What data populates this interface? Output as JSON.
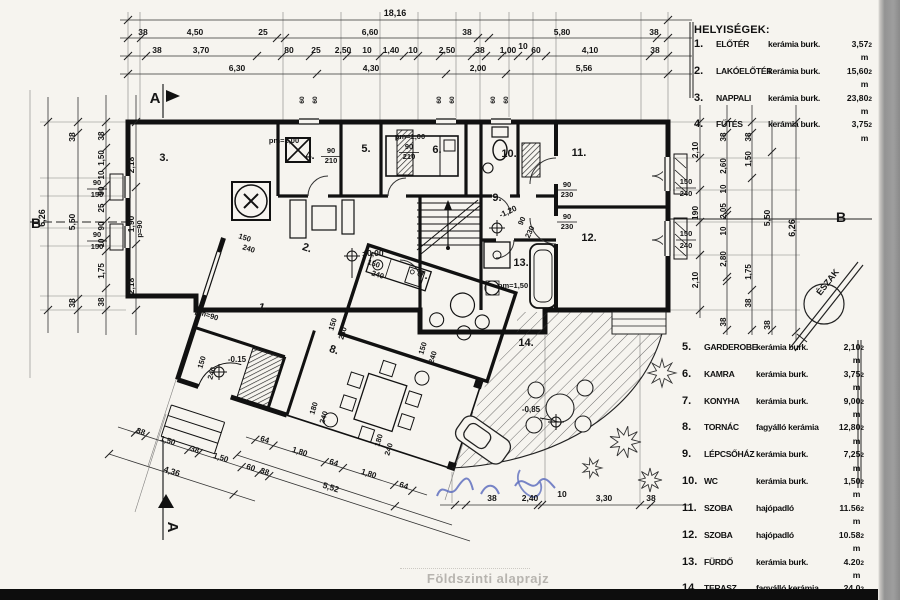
{
  "title": {
    "caption": "Földszinti alaprajz"
  },
  "legend_top": {
    "heading": "HELYISÉGEK:",
    "items": [
      {
        "num": "1.",
        "name": "ELŐTÉR",
        "material": "kerámia burk.",
        "area": "3,57 m"
      },
      {
        "num": "2.",
        "name": "LAKÓELŐTÉR",
        "material": "kerámia burk.",
        "area": "15,60 m"
      },
      {
        "num": "3.",
        "name": "NAPPALI",
        "material": "kerámia burk.",
        "area": "23,80 m"
      },
      {
        "num": "4.",
        "name": "FŰTÉS",
        "material": "kerámia burk.",
        "area": "3,75 m"
      }
    ]
  },
  "legend_bottom": {
    "items": [
      {
        "num": "5.",
        "name": "GARDEROBE",
        "material": "kerámia burk.",
        "area": "2,10 m"
      },
      {
        "num": "6.",
        "name": "KAMRA",
        "material": "kerámia burk.",
        "area": "3,75 m"
      },
      {
        "num": "7.",
        "name": "KONYHA",
        "material": "kerámia burk.",
        "area": "9,00 m"
      },
      {
        "num": "8.",
        "name": "TORNÁC",
        "material": "fagyálló kerámia",
        "area": "12,80 m"
      },
      {
        "num": "9.",
        "name": "LÉPCSŐHÁZ",
        "material": "kerámia burk.",
        "area": "7,25 m"
      },
      {
        "num": "10.",
        "name": "WC",
        "material": "kerámia burk.",
        "area": "1,50 m"
      },
      {
        "num": "11.",
        "name": "SZOBA",
        "material": "hajópadló",
        "area": "11.56 m"
      },
      {
        "num": "12.",
        "name": "SZOBA",
        "material": "hajópadló",
        "area": "10.58 m"
      },
      {
        "num": "13.",
        "name": "FÜRDŐ",
        "material": "kerámia burk.",
        "area": "4.20 m"
      },
      {
        "num": "14.",
        "name": "TERASZ",
        "material": "fagyálló kerámia",
        "area": "24,0 m"
      }
    ]
  },
  "sup": "2",
  "north": {
    "label": "ÉSZAK"
  },
  "sections": {
    "a": "A",
    "b": "B"
  },
  "rooms": {
    "r1": "1.",
    "r2": "2.",
    "r3": "3.",
    "r4": "4.",
    "r5": "5.",
    "r6": "6.",
    "r7": "7.",
    "r8": "8.",
    "r9": "9.",
    "r10": "10.",
    "r11": "11.",
    "r12": "12.",
    "r13": "13.",
    "r14": "14."
  },
  "levels": {
    "zero": "±0,00",
    "entry": "-0.15",
    "terrace": "-0,85",
    "stair": "-1,20"
  },
  "notes": {
    "pm90": "pm=90",
    "pm100": "pm=1,00",
    "pm150": "pm=1,50",
    "p90": "p=90"
  },
  "openings": {
    "d210": {
      "w": "90",
      "h": "210"
    },
    "d230": {
      "w": "90",
      "h": "230"
    },
    "w150": {
      "w": "150",
      "h": "240"
    },
    "w180": {
      "w": "180",
      "h": "240"
    },
    "w90": {
      "w": "90",
      "h": "150"
    },
    "w60": "60"
  },
  "dims": {
    "total_top": "18,16",
    "top2": [
      "38",
      "4,50",
      "25",
      "6,60",
      "38",
      "5,80",
      "38"
    ],
    "top3": [
      "38",
      "3,70",
      "80",
      "25",
      "2,50",
      "10",
      "1,40",
      "10",
      "2,50",
      "38",
      "1,00",
      "10",
      "60",
      "4,10",
      "38"
    ],
    "top4": [
      "6,30",
      "4,30",
      "2,00",
      "5,56"
    ],
    "left_total": "6,26",
    "left_outer": [
      "38",
      "5,50",
      "38"
    ],
    "left_mid": [
      "38",
      "1,50",
      "10",
      "90",
      "25",
      "90",
      "10",
      "1,75",
      "38"
    ],
    "left_inner": [
      "2,18",
      "1,90",
      "2,18"
    ],
    "right_inner": [
      "2,10",
      "190",
      "2,10"
    ],
    "right_mid": [
      "38",
      "2,60",
      "10",
      "2,05",
      "10",
      "2,80",
      "38"
    ],
    "right_outer": [
      "38",
      "1,50",
      "1,75",
      "38"
    ],
    "right_room": [
      "5,50",
      "38"
    ],
    "right_total": "6,26",
    "bottom": [
      "38",
      "2,40",
      "10",
      "3,30",
      "38"
    ],
    "diag_a": [
      "38",
      "1,50",
      "38",
      "1,50",
      "60",
      "38"
    ],
    "diag_b": [
      "4,36",
      "5,52"
    ],
    "diag_c": [
      "64",
      "1,80",
      "64",
      "1,80",
      "64"
    ]
  }
}
